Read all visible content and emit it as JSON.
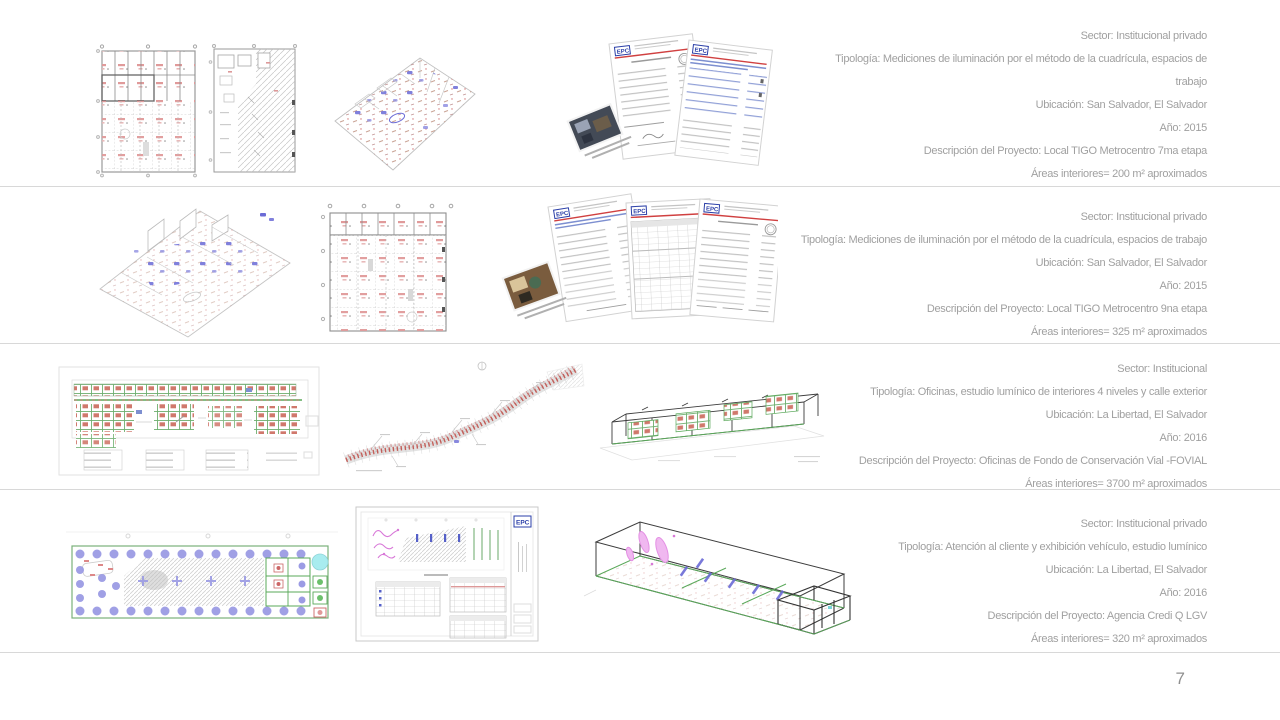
{
  "page": {
    "number": "7"
  },
  "docs": {
    "logo": "EPC"
  },
  "colors": {
    "text": "#a0a0a0",
    "divider": "#d8d8d8",
    "page_number": "#8f8f8f",
    "logo_blue": "#2b3fa8",
    "rule_red": "#d04040",
    "plan_red": "#d98f8f",
    "fixture_blue": "#6b6bd6",
    "plan_green": "#5aa85a",
    "circle_purple": "#9b9be4",
    "highlight_cyan": "#a8ecef",
    "squiggle_magenta": "#d878d8"
  },
  "projects": [
    {
      "thumbnails": [
        "reflected-ceiling-plan",
        "sampling-points-plan",
        "isometric-lighting-model",
        "measurement-report-pages"
      ],
      "lines": [
        "Sector: Institucional privado",
        "Tipología: Mediciones de iluminación por el método de la cuadrícula, espacios de",
        "trabajo",
        "Ubicación: San Salvador, El Salvador",
        "Año: 2015",
        "Descripción del Proyecto: Local TIGO Metrocentro 7ma etapa",
        "Áreas interiores= 200 m² aproximados"
      ]
    },
    {
      "thumbnails": [
        "isometric-lighting-model",
        "sampling-grid-plan",
        "measurement-report-pages"
      ],
      "lines": [
        "Sector: Institucional privado",
        "Tipología: Mediciones de iluminación por el método de la cuadrícula, espacios de trabajo",
        "Ubicación: San Salvador, El Salvador",
        "Año: 2015",
        "Descripción del Proyecto: Local TIGO Metrocentro 9na etapa",
        "Áreas interiores= 325 m² aproximados"
      ]
    },
    {
      "thumbnails": [
        "office-floor-plan",
        "exterior-street-plan",
        "isometric-building-model"
      ],
      "lines": [
        "Sector: Institucional",
        "Tipología: Oficinas, estudio lumínico de interiores 4 niveles y calle exterior",
        "Ubicación: La Libertad, El Salvador",
        "Año: 2016",
        "Descripción del Proyecto: Oficinas de Fondo de Conservación Vial -FOVIAL",
        "Áreas interiores= 3700 m² aproximados"
      ]
    },
    {
      "thumbnails": [
        "showroom-floor-plan",
        "layout-sheet",
        "isometric-building-model"
      ],
      "lines": [
        "Sector: Institucional privado",
        "Tipología: Atención al cliente y exhibición vehículo, estudio lumínico",
        "Ubicación: La Libertad, El Salvador",
        "Año: 2016",
        "Descripción del Proyecto: Agencia Credi Q LGV",
        "Áreas interiores= 320 m² aproximados"
      ]
    }
  ]
}
